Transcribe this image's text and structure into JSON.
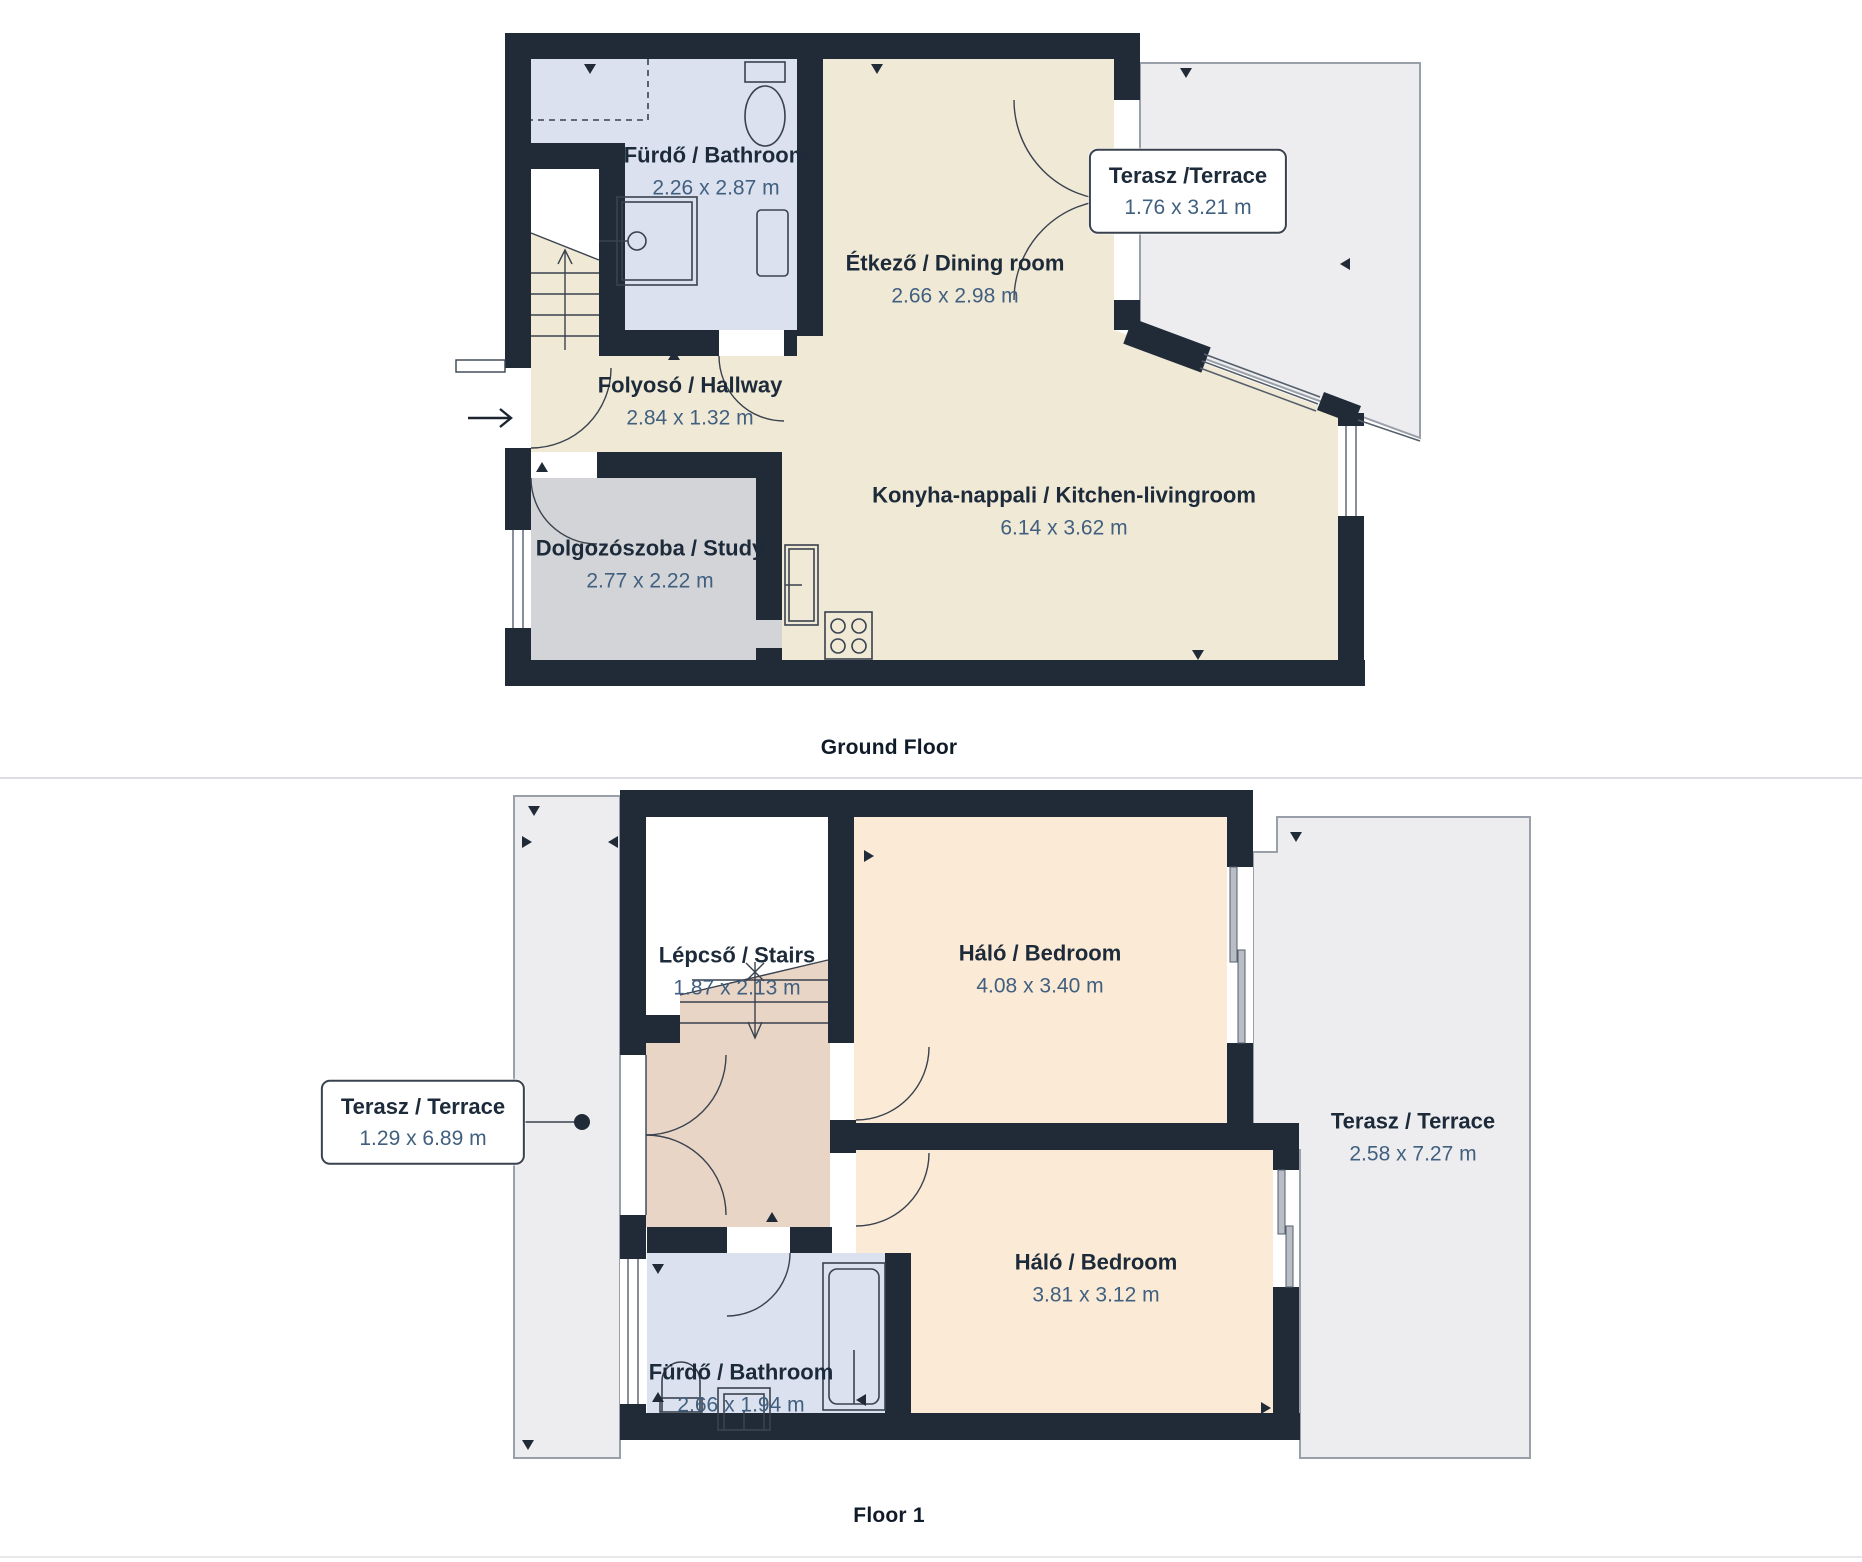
{
  "ground_floor": {
    "caption": "Ground Floor",
    "rooms": {
      "bathroom": {
        "label": "Fürdő / Bathroom",
        "dims": "2.26 x 2.87 m"
      },
      "terrace": {
        "label": "Terasz /Terrace",
        "dims": "1.76 x 3.21 m"
      },
      "dining": {
        "label": "Étkező / Dining room",
        "dims": "2.66 x 2.98 m"
      },
      "hallway": {
        "label": "Folyosó / Hallway",
        "dims": "2.84 x 1.32 m"
      },
      "kitchen_living": {
        "label": "Konyha-nappali / Kitchen-livingroom",
        "dims": "6.14 x 3.62 m"
      },
      "study": {
        "label": "Dolgozószoba / Study",
        "dims": "2.77 x 2.22 m"
      }
    }
  },
  "floor_1": {
    "caption": "Floor 1",
    "rooms": {
      "stairs": {
        "label": "Lépcső / Stairs",
        "dims": "1.87 x 2.13 m"
      },
      "bedroom_top": {
        "label": "Háló / Bedroom",
        "dims": "4.08 x 3.40 m"
      },
      "terrace_left": {
        "label": "Terasz / Terrace",
        "dims": "1.29 x 6.89 m"
      },
      "terrace_right": {
        "label": "Terasz / Terrace",
        "dims": "2.58 x 7.27 m"
      },
      "bedroom_bottom": {
        "label": "Háló / Bedroom",
        "dims": "3.81 x 3.12 m"
      },
      "bathroom": {
        "label": "Fürdő / Bathroom",
        "dims": "2.66 x 1.94 m"
      }
    }
  },
  "colors": {
    "wall": "#212b38",
    "floor_beige": "#f0e9d6",
    "floor_bath": "#dbe1ee",
    "floor_study": "#d3d4d7",
    "floor_peach": "#fbead5",
    "floor_tan": "#e9d5c5",
    "terrace": "#ededef",
    "terrace_border": "#9aa0a9"
  }
}
